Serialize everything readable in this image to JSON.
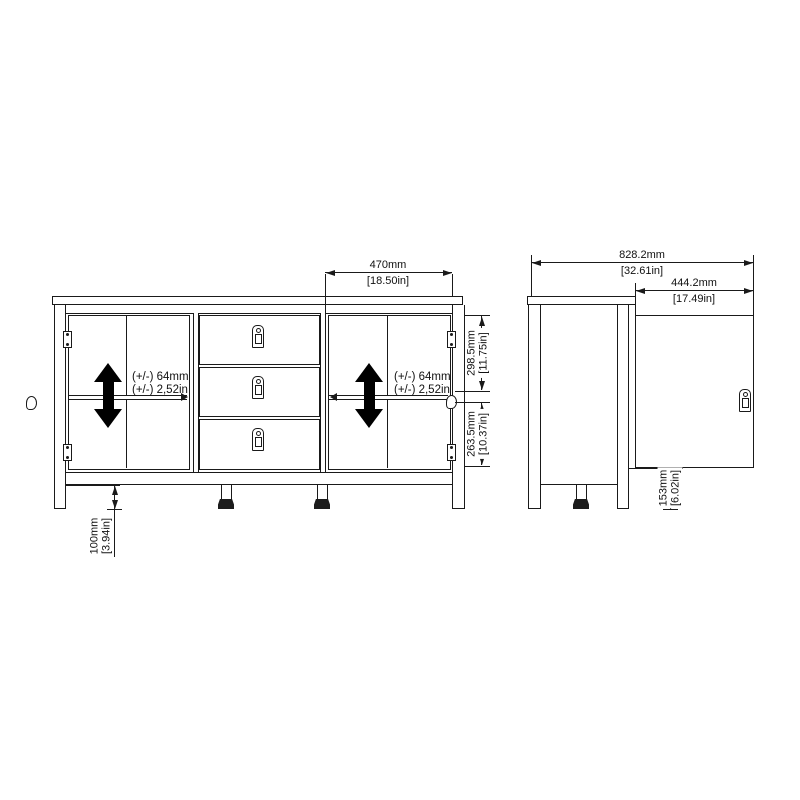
{
  "drawing": {
    "subject": "sideboard with 2 doors and 3 drawers, front and side dimension views"
  },
  "front_view": {
    "door_width": {
      "mm": "470mm",
      "in": "[18.50in]"
    },
    "left_shelf_tolerance": {
      "mm": "(+/-) 64mm",
      "in": "(+/-) 2,52in"
    },
    "right_shelf_tolerance": {
      "mm": "(+/-) 64mm",
      "in": "(+/-) 2,52in"
    },
    "upper_compartment": {
      "mm": "298.5mm",
      "in": "[11.75in]"
    },
    "lower_compartment": {
      "mm": "263.5mm",
      "in": "[10.37in]"
    },
    "leg_height": {
      "mm": "100mm",
      "in": "[3.94in]"
    }
  },
  "side_view": {
    "depth_with_open_door": {
      "mm": "828.2mm",
      "in": "[32.61in]"
    },
    "door_width": {
      "mm": "444.2mm",
      "in": "[17.49in]"
    },
    "door_ground_clearance": {
      "mm": "153mm",
      "in": "[6.02in]"
    }
  },
  "colors": {
    "line": "#1a1a1a",
    "arrow": "#000000",
    "background": "#ffffff"
  }
}
